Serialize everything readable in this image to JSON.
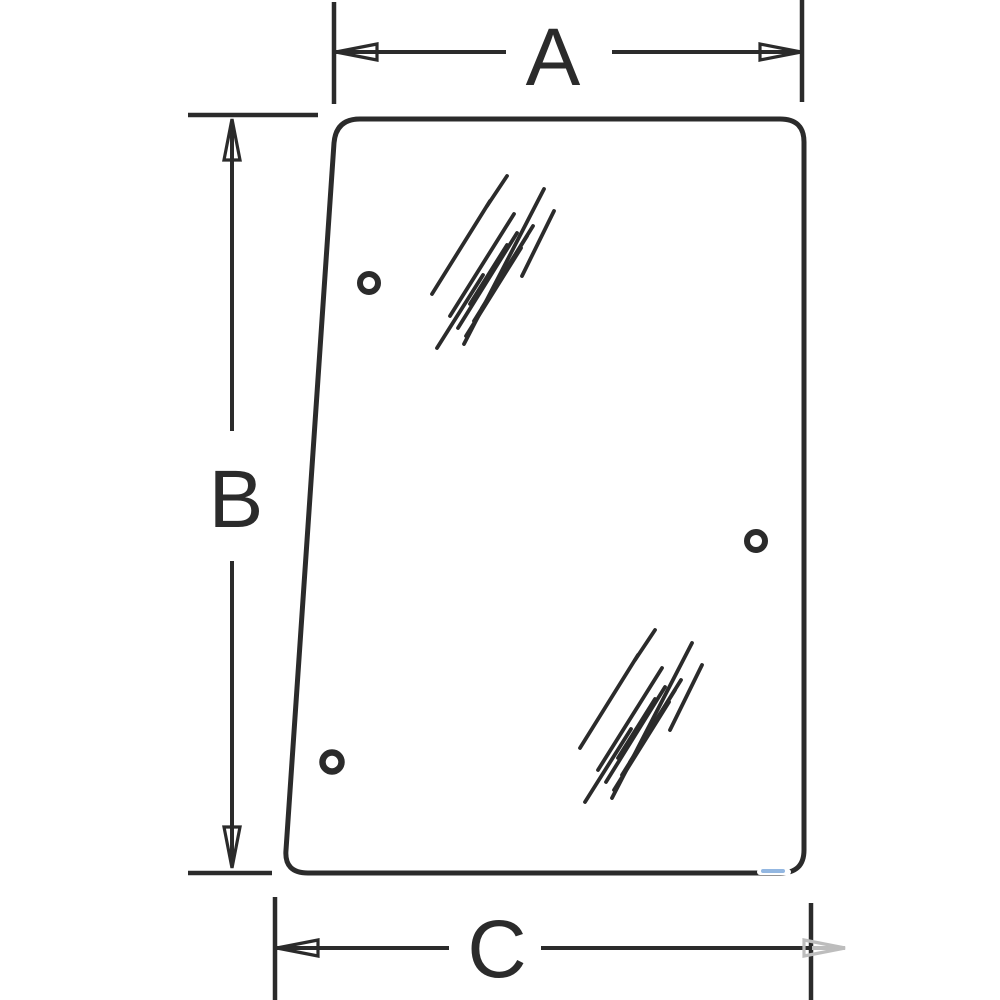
{
  "drawing": {
    "labels": {
      "a": "A",
      "b": "B",
      "c": "C"
    },
    "colors": {
      "line": "#2b2b2b",
      "background": "#ffffff",
      "faded_arrow": "#bdbdbd",
      "artifact_blue": "#6f9fd8"
    }
  }
}
